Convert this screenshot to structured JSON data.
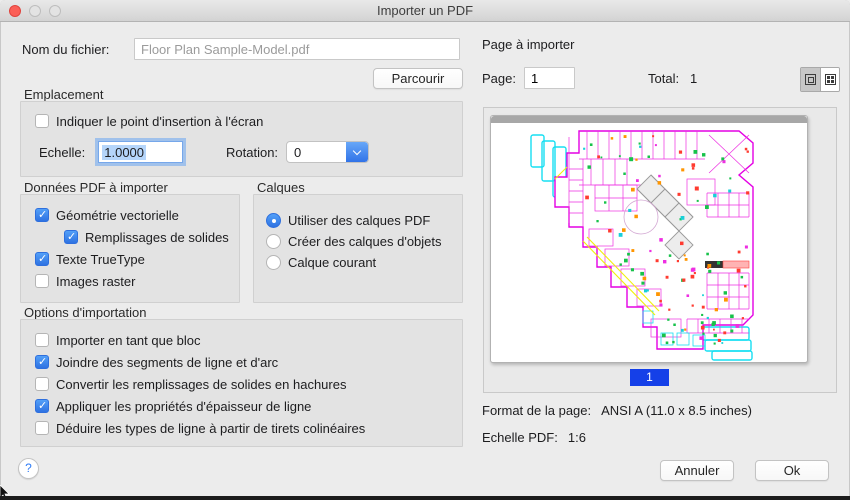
{
  "window": {
    "title": "Importer un PDF"
  },
  "file": {
    "label": "Nom du fichier:",
    "value": "Floor Plan Sample-Model.pdf",
    "browse_label": "Parcourir"
  },
  "emplacement": {
    "title": "Emplacement",
    "insertion_checkbox": {
      "label": "Indiquer le point d'insertion à l'écran",
      "checked": false
    },
    "scale_label": "Echelle:",
    "scale_value": "1.0000",
    "rotation_label": "Rotation:",
    "rotation_value": "0"
  },
  "pdf_data": {
    "title": "Données PDF à importer",
    "items": [
      {
        "label": "Géométrie vectorielle",
        "checked": true
      },
      {
        "label": "Remplissages de solides",
        "checked": true
      },
      {
        "label": "Texte TrueType",
        "checked": true
      },
      {
        "label": "Images raster",
        "checked": false
      }
    ]
  },
  "calques": {
    "title": "Calques",
    "options": [
      {
        "label": "Utiliser des calques PDF",
        "selected": true
      },
      {
        "label": "Créer des calques d'objets",
        "selected": false
      },
      {
        "label": "Calque courant",
        "selected": false
      }
    ]
  },
  "import_options": {
    "title": "Options d'importation",
    "items": [
      {
        "label": "Importer en tant que bloc",
        "checked": false
      },
      {
        "label": "Joindre des segments de ligne et d'arc",
        "checked": true
      },
      {
        "label": "Convertir les remplissages de solides en hachures",
        "checked": false
      },
      {
        "label": "Appliquer les propriétés d'épaisseur de ligne",
        "checked": true
      },
      {
        "label": "Déduire les types de ligne à partir de tirets colinéaires",
        "checked": false
      }
    ]
  },
  "page_panel": {
    "title": "Page à importer",
    "page_label": "Page:",
    "page_value": "1",
    "total_label": "Total:",
    "total_value": "1",
    "badge": "1",
    "format_label": "Format de la page:",
    "format_value": "ANSI A (11.0 x 8.5 inches)",
    "pdf_scale_label": "Echelle PDF:",
    "pdf_scale_value": "1:6"
  },
  "footer": {
    "help": "?",
    "cancel": "Annuler",
    "ok": "Ok"
  },
  "colors": {
    "accent": "#3478f6",
    "selection": "#b5d5fa",
    "badge": "#1540e8"
  }
}
